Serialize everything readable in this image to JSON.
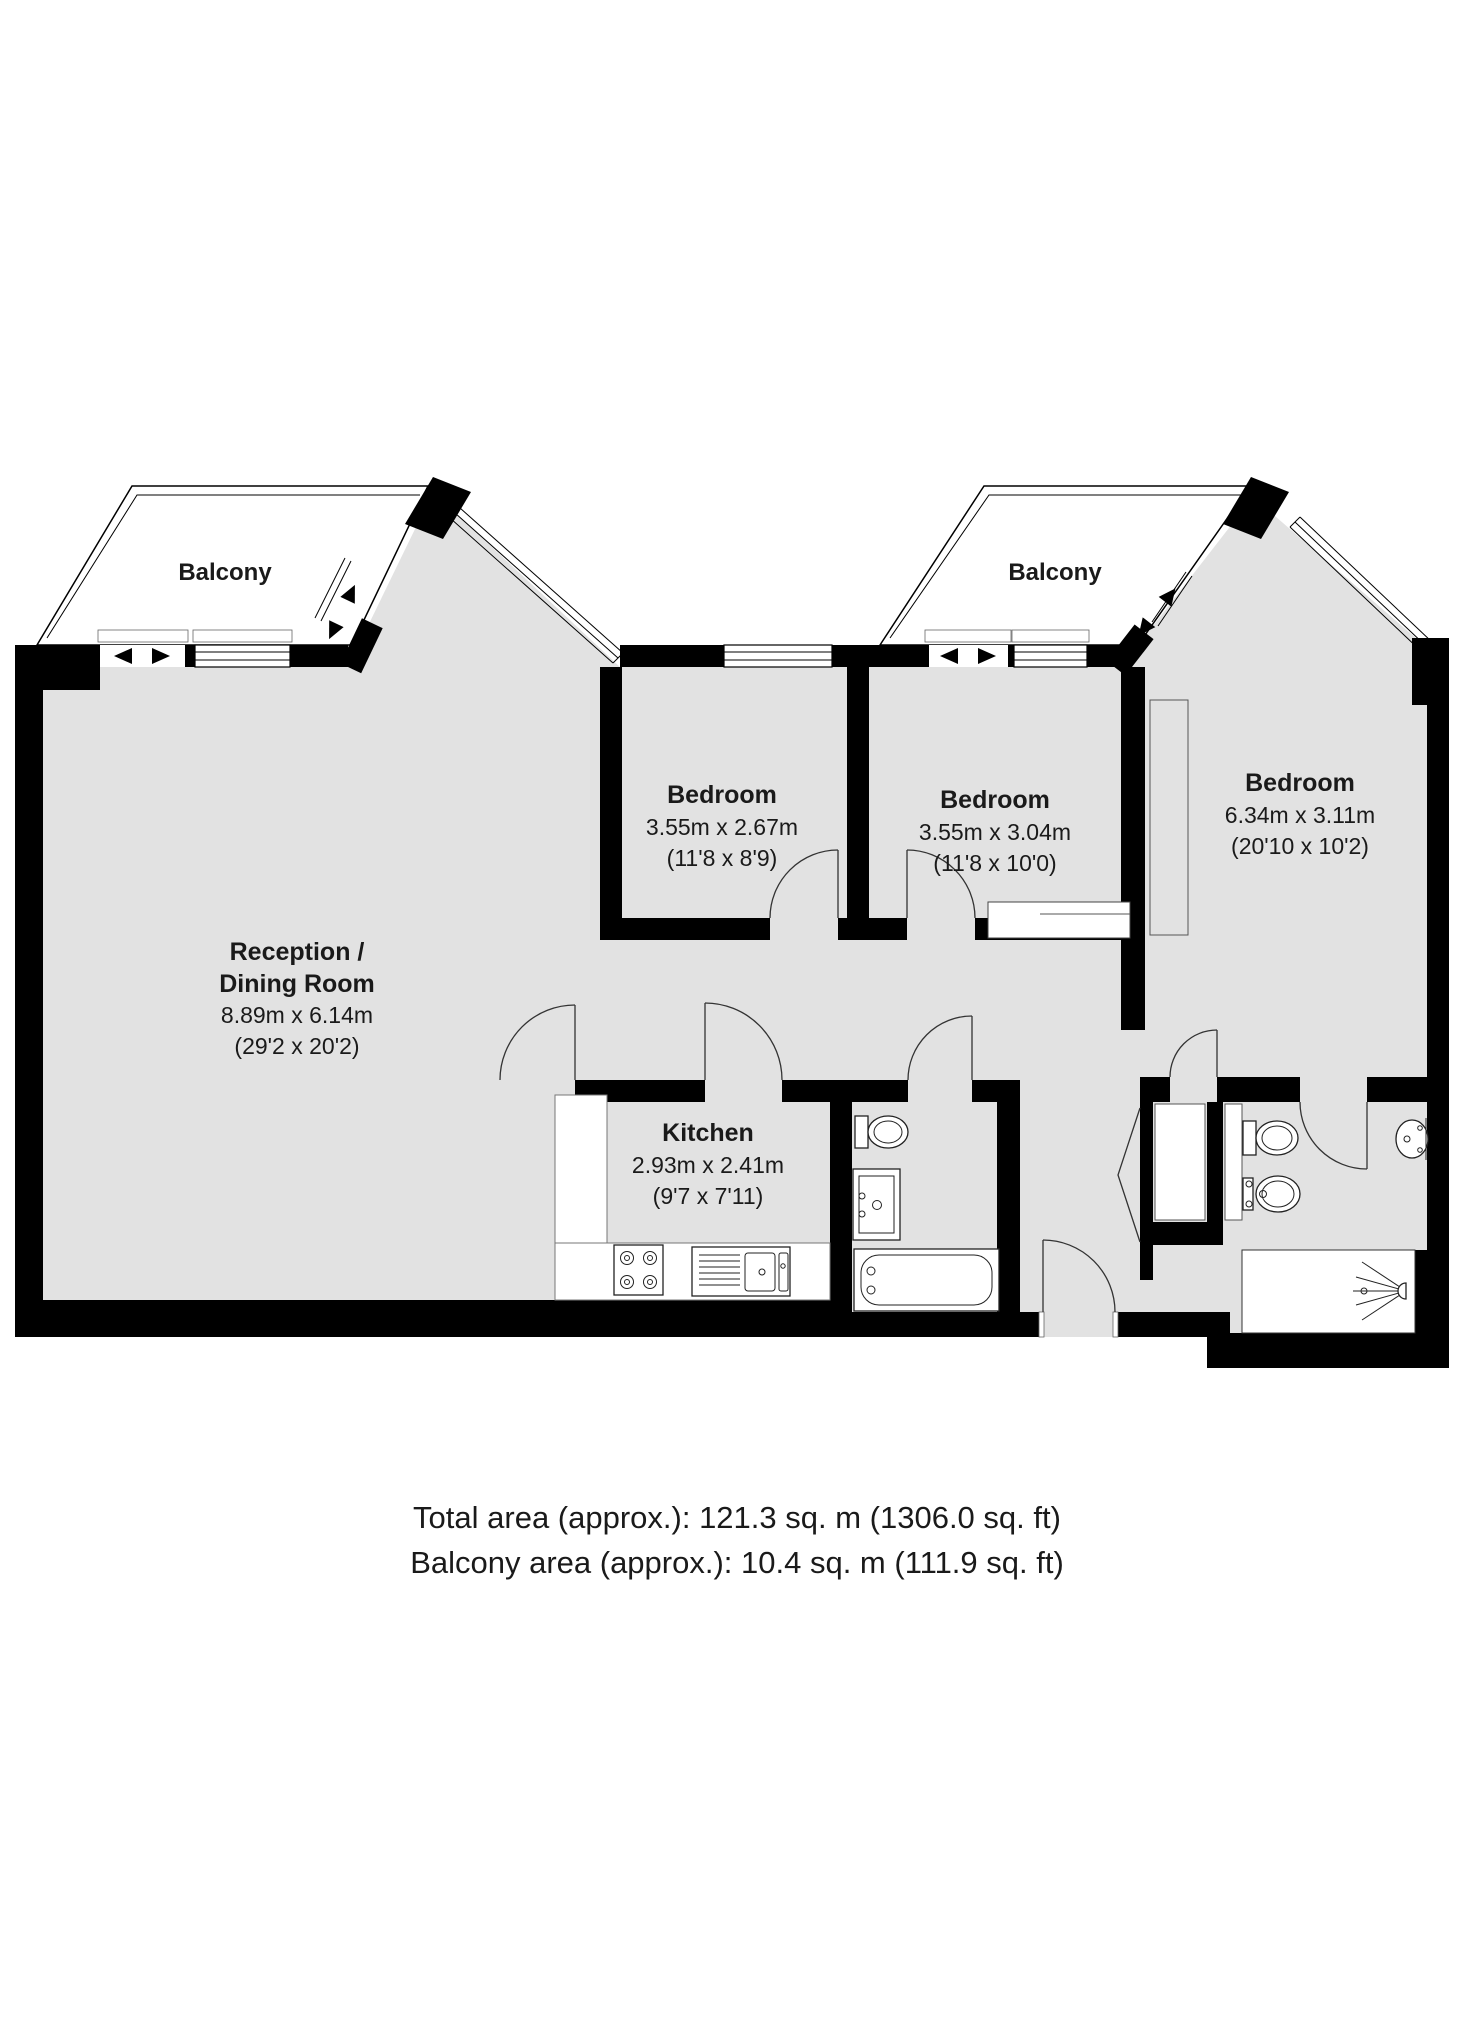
{
  "plan": {
    "balconies": [
      {
        "label": "Balcony"
      },
      {
        "label": "Balcony"
      }
    ],
    "rooms": [
      {
        "name_line1": "Reception /",
        "name_line2": "Dining Room",
        "dims_m": "8.89m x 6.14m",
        "dims_ft": "(29'2 x 20'2)"
      },
      {
        "name_line1": "Bedroom",
        "dims_m": "3.55m x 2.67m",
        "dims_ft": "(11'8 x 8'9)"
      },
      {
        "name_line1": "Bedroom",
        "dims_m": "3.55m x 3.04m",
        "dims_ft": "(11'8 x 10'0)"
      },
      {
        "name_line1": "Bedroom",
        "dims_m": "6.34m x 3.11m",
        "dims_ft": "(20'10 x 10'2)"
      },
      {
        "name_line1": "Kitchen",
        "dims_m": "2.93m x 2.41m",
        "dims_ft": "(9'7 x 7'11)"
      }
    ],
    "footer": {
      "line1": "Total area (approx.): 121.3 sq. m (1306.0 sq. ft)",
      "line2": "Balcony area (approx.): 10.4 sq. m (111.9 sq. ft)"
    },
    "colors": {
      "floor": "#e2e2e2",
      "wall": "#000000",
      "background": "#ffffff"
    }
  }
}
